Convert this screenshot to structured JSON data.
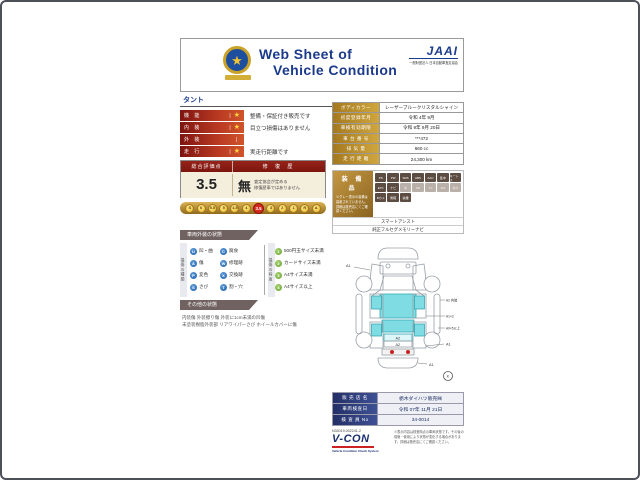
{
  "colors": {
    "navy": "#1b3a8c",
    "maroon": "#7c150f",
    "gold": "#cfa63e",
    "red_grade": "#d42a1e",
    "glass_cyan": "#7fdce2",
    "tail_red": "#cc2020"
  },
  "header": {
    "title_line1": "Web Sheet of",
    "title_line2": "Vehicle Condition",
    "jaai_mark": "JAAI",
    "jaai_sub": "一般財団法人 日本自動車査定協会",
    "emblem_star": "★"
  },
  "model_name": "タント",
  "ratings": [
    {
      "label": "機 能",
      "star": true,
      "text": "整備・保証付き販売です"
    },
    {
      "label": "内 装",
      "star": true,
      "text": "目立つ損傷はありません"
    },
    {
      "label": "外 装",
      "star": false,
      "text": ""
    },
    {
      "label": "走 行",
      "star": true,
      "text": "実走行距離です"
    }
  ],
  "score": {
    "header_left": "総合評価点",
    "header_right": "修 復 歴",
    "value": "3.5",
    "repair": "無",
    "repair_note1": "査定協会が定める",
    "repair_note2": "修復歴車ではありません"
  },
  "scale": {
    "values": [
      "S",
      "6",
      "5.5",
      "5",
      "4.5",
      "4",
      "3.5",
      "3",
      "2",
      "1",
      "R",
      "A"
    ],
    "active_index": 6
  },
  "vehicle_info": [
    {
      "label": "ボディカラー",
      "value": "レーザーブルークリスタルシャイン"
    },
    {
      "label": "初度登録年月",
      "value": "令和 4年 9月"
    },
    {
      "label": "車検有効期限",
      "value": "令和 9年 9月 20日"
    },
    {
      "label": "車 台 番 号",
      "value": "***472"
    },
    {
      "label": "排  気  量",
      "value": "660 cc"
    },
    {
      "label": "走 行 距 離",
      "value": "24,300 km"
    }
  ],
  "equipment": {
    "title": "装 備 品",
    "note": "※グレー表示の装備は装着されていません。詳細は販売店にてご確認ください。",
    "badges": [
      {
        "label": "PS",
        "on": true
      },
      {
        "label": "PW",
        "on": true
      },
      {
        "label": "SRS",
        "on": true
      },
      {
        "label": "ABS",
        "on": true
      },
      {
        "label": "AAC",
        "on": true
      },
      {
        "label": "集中",
        "on": true
      },
      {
        "label": "キーレス",
        "on": true
      },
      {
        "label": "ETC",
        "on": true
      },
      {
        "label": "ナビ",
        "on": true
      },
      {
        "label": "革",
        "on": false
      },
      {
        "label": "SR",
        "on": false
      },
      {
        "label": "TV",
        "on": false
      },
      {
        "label": "AW",
        "on": false
      },
      {
        "label": "寒冷",
        "on": false
      },
      {
        "label": "Bカメ",
        "on": true
      },
      {
        "label": "衝軽",
        "on": true
      },
      {
        "label": "禁煙",
        "on": true
      }
    ],
    "extras": [
      "スマートアシスト",
      "純正フルセグメモリーナビ"
    ]
  },
  "exterior_section": {
    "title": "車両外装の状態",
    "type_label": "損傷の種類",
    "types": [
      {
        "code": "U",
        "text": "凹・曲"
      },
      {
        "code": "C",
        "text": "腐食"
      },
      {
        "code": "A",
        "text": "傷"
      },
      {
        "code": "W",
        "text": "修理跡"
      },
      {
        "code": "P",
        "text": "変色"
      },
      {
        "code": "X",
        "text": "交換跡"
      },
      {
        "code": "S",
        "text": "さび"
      },
      {
        "code": "T",
        "text": "割・穴"
      }
    ],
    "degree_label": "損傷の程度",
    "degrees": [
      {
        "num": "1",
        "text": "500円玉サイズ未満"
      },
      {
        "num": "2",
        "text": "カードサイズ未満"
      },
      {
        "num": "3",
        "text": "A4サイズ未満"
      },
      {
        "num": "4",
        "text": "A4サイズ以上"
      }
    ]
  },
  "other_section": {
    "title": "その他の状態",
    "line1": "内装傷 外装擦り傷 外装に1cm未満の凹傷",
    "line2": "未塗装樹脂外装部 リアワイパーさび ホイールカバーに傷"
  },
  "diagram": {
    "front_left": "A1",
    "right_top": "A2 内装",
    "right_mid": "A1×3",
    "right_low": "A0×5以上",
    "right_rear": "A1",
    "tailgate_1": "A2",
    "tailgate_2": "A2",
    "rear_bumper": "A1",
    "mark": "K"
  },
  "sales": [
    {
      "label": "販 売 店 名",
      "value": "栃木ダイハツ販売㈱"
    },
    {
      "label": "車両検査日",
      "value": "令和 07年 11月 21日"
    },
    {
      "label": "検 査 員 No",
      "value": "34-0014"
    }
  ],
  "footer": {
    "serial": "N34019-002241-2",
    "vcon": "V-CON",
    "vcon_sub": "Vehicle Condition Check System",
    "disclaimer": "※表示内容は検査時点の車両状態です。その後の保管・使用により状態が変化する場合があります。詳細は販売店にてご確認ください。"
  }
}
